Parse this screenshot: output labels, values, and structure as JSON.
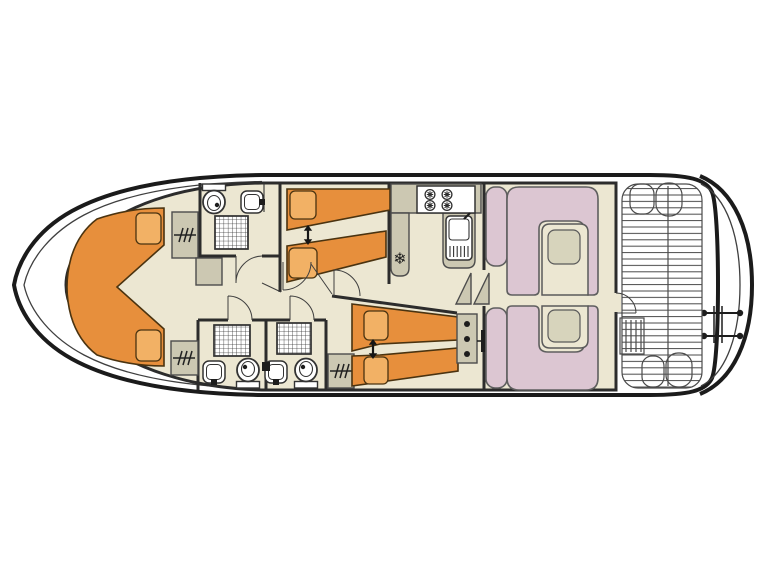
{
  "diagram": {
    "title": "Houseboat deck plan",
    "type": "boat floor plan, top view",
    "orientation": "bow at left, stern with aft deck and swim platform at right"
  },
  "colors": {
    "background": "#ffffff",
    "hull_outline": "#1b1b1b",
    "wall": "#2c2c2c",
    "line": "#3f3f3f",
    "floor": "#ece7d2",
    "bed": "#e78f3c",
    "bed_outline": "#4a3310",
    "pillow": "#f2b165",
    "cabinet": "#ccc8b2",
    "seating": "#dcc6d2",
    "seating_outline": "#5f5f5f",
    "table": "#ece7d2",
    "table_pad": "#d7d4bc"
  },
  "icons": {
    "snowflake": "❄",
    "bed_slide_arrow": "vertical double-headed arrow",
    "hanging_locker": "horizontal line crossed by three slashes",
    "shower": "square grid mesh",
    "stove_burner": "circle with cross petals"
  },
  "counts": {
    "cabins": 3,
    "bathrooms": 3,
    "double_beds": 1,
    "single_beds": 4,
    "wardrobes": 3,
    "dinette_tables": 2,
    "stove_burners": 4,
    "showers": 3,
    "toilets": 3,
    "washbasins": 4
  },
  "sections": [
    {
      "name": "bow-cabin",
      "position": "bow",
      "features": [
        "V-shaped double berth",
        "2 pillows",
        "hanging wardrobe",
        "storage cabinet"
      ]
    },
    {
      "name": "forward-bathroom",
      "position": "forward starboard",
      "features": [
        "shower",
        "toilet",
        "washbasin"
      ]
    },
    {
      "name": "midship-cabin",
      "position": "midship starboard",
      "features": [
        "2 single beds that slide together",
        "slide arrow symbol"
      ]
    },
    {
      "name": "aft-bathroom-1",
      "position": "midship port",
      "features": [
        "shower",
        "toilet",
        "washbasin"
      ]
    },
    {
      "name": "aft-bathroom-2",
      "position": "midship port",
      "features": [
        "shower",
        "toilet",
        "washbasin",
        "hanging wardrobe"
      ]
    },
    {
      "name": "aft-cabin",
      "position": "aft port",
      "features": [
        "2 single beds that slide together",
        "slide arrow symbol",
        "cabinet with three knobs"
      ]
    },
    {
      "name": "galley",
      "position": "midship",
      "features": [
        "4-burner stove",
        "sink with drainboard",
        "refrigerator marked with snowflake",
        "L-shaped counter",
        "two step treads"
      ]
    },
    {
      "name": "saloon",
      "position": "aft of galley",
      "features": [
        "2 U-shaped bench seats",
        "2 tables",
        "2 side seat cushions",
        "door to aft deck"
      ]
    },
    {
      "name": "aft-deck",
      "position": "stern",
      "features": [
        "planked floor",
        "entry steps",
        "4 seat cushions",
        "centre divider"
      ]
    },
    {
      "name": "swim-platform",
      "position": "stern extremity",
      "features": [
        "boarding ladder",
        "grab rails with end knobs"
      ]
    }
  ]
}
